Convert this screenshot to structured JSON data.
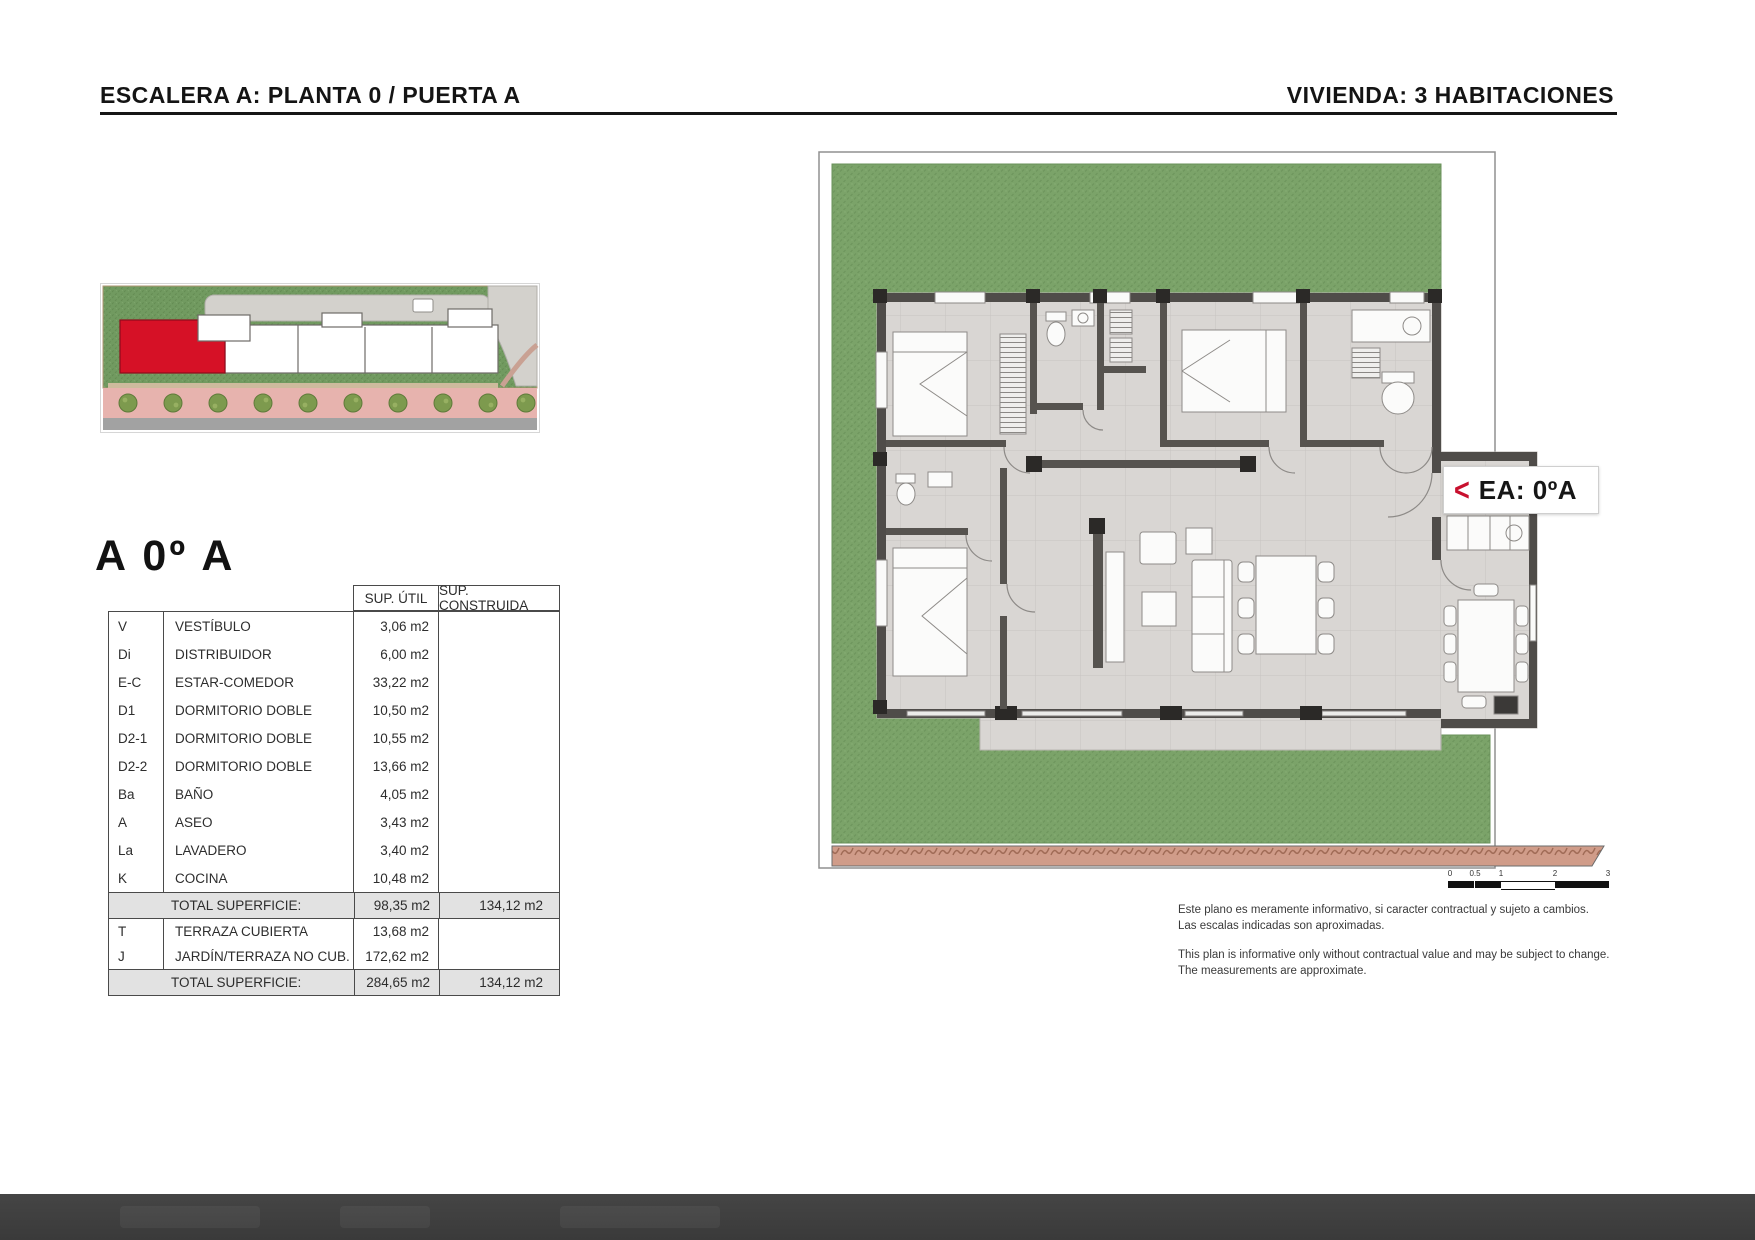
{
  "header": {
    "left": "ESCALERA A: PLANTA 0 / PUERTA A",
    "right": "VIVIENDA: 3 HABITACIONES"
  },
  "unit": {
    "title": "A 0º A"
  },
  "table": {
    "col_util": "SUP. ÚTIL",
    "col_construida": "SUP. CONSTRUIDA",
    "rooms": [
      {
        "code": "V",
        "name": "VESTÍBULO",
        "util": "3,06 m2"
      },
      {
        "code": "Di",
        "name": "DISTRIBUIDOR",
        "util": "6,00 m2"
      },
      {
        "code": "E-C",
        "name": "ESTAR-COMEDOR",
        "util": "33,22 m2"
      },
      {
        "code": "D1",
        "name": "DORMITORIO DOBLE",
        "util": "10,50 m2"
      },
      {
        "code": "D2-1",
        "name": "DORMITORIO DOBLE",
        "util": "10,55 m2"
      },
      {
        "code": "D2-2",
        "name": "DORMITORIO DOBLE",
        "util": "13,66 m2"
      },
      {
        "code": "Ba",
        "name": "BAÑO",
        "util": "4,05 m2"
      },
      {
        "code": "A",
        "name": "ASEO",
        "util": "3,43 m2"
      },
      {
        "code": "La",
        "name": "LAVADERO",
        "util": "3,40 m2"
      },
      {
        "code": "K",
        "name": "COCINA",
        "util": "10,48 m2"
      }
    ],
    "total_label": "TOTAL SUPERFICIE:",
    "total_util": "98,35 m2",
    "total_construida": "134,12 m2",
    "extras": [
      {
        "code": "T",
        "name": "TERRAZA CUBIERTA",
        "util": "13,68 m2"
      },
      {
        "code": "J",
        "name": "JARDÍN/TERRAZA NO CUB.",
        "util": "172,62 m2"
      }
    ],
    "grand_total_label": "TOTAL SUPERFICIE:",
    "grand_total_util": "284,65 m2",
    "grand_total_construida": "134,12 m2"
  },
  "plan": {
    "entrance_arrow": "<",
    "entrance_label": "EA: 0ºA",
    "scale_ticks": [
      "0",
      "0.5",
      "1",
      "2",
      "3"
    ],
    "disclaimer_es_1": "Este plano es meramente informativo, si caracter contractual y sujeto a cambios.",
    "disclaimer_es_2": "Las escalas indicadas son aproximadas.",
    "disclaimer_en_1": "This plan is informative only without contractual value and may be subject to change.",
    "disclaimer_en_2": "The measurements are approximate."
  },
  "colors": {
    "accent_red": "#d6112b",
    "garden_green": "#7ba369",
    "wall_gray": "#4f4c49",
    "total_row_bg": "#e2e2e2"
  }
}
